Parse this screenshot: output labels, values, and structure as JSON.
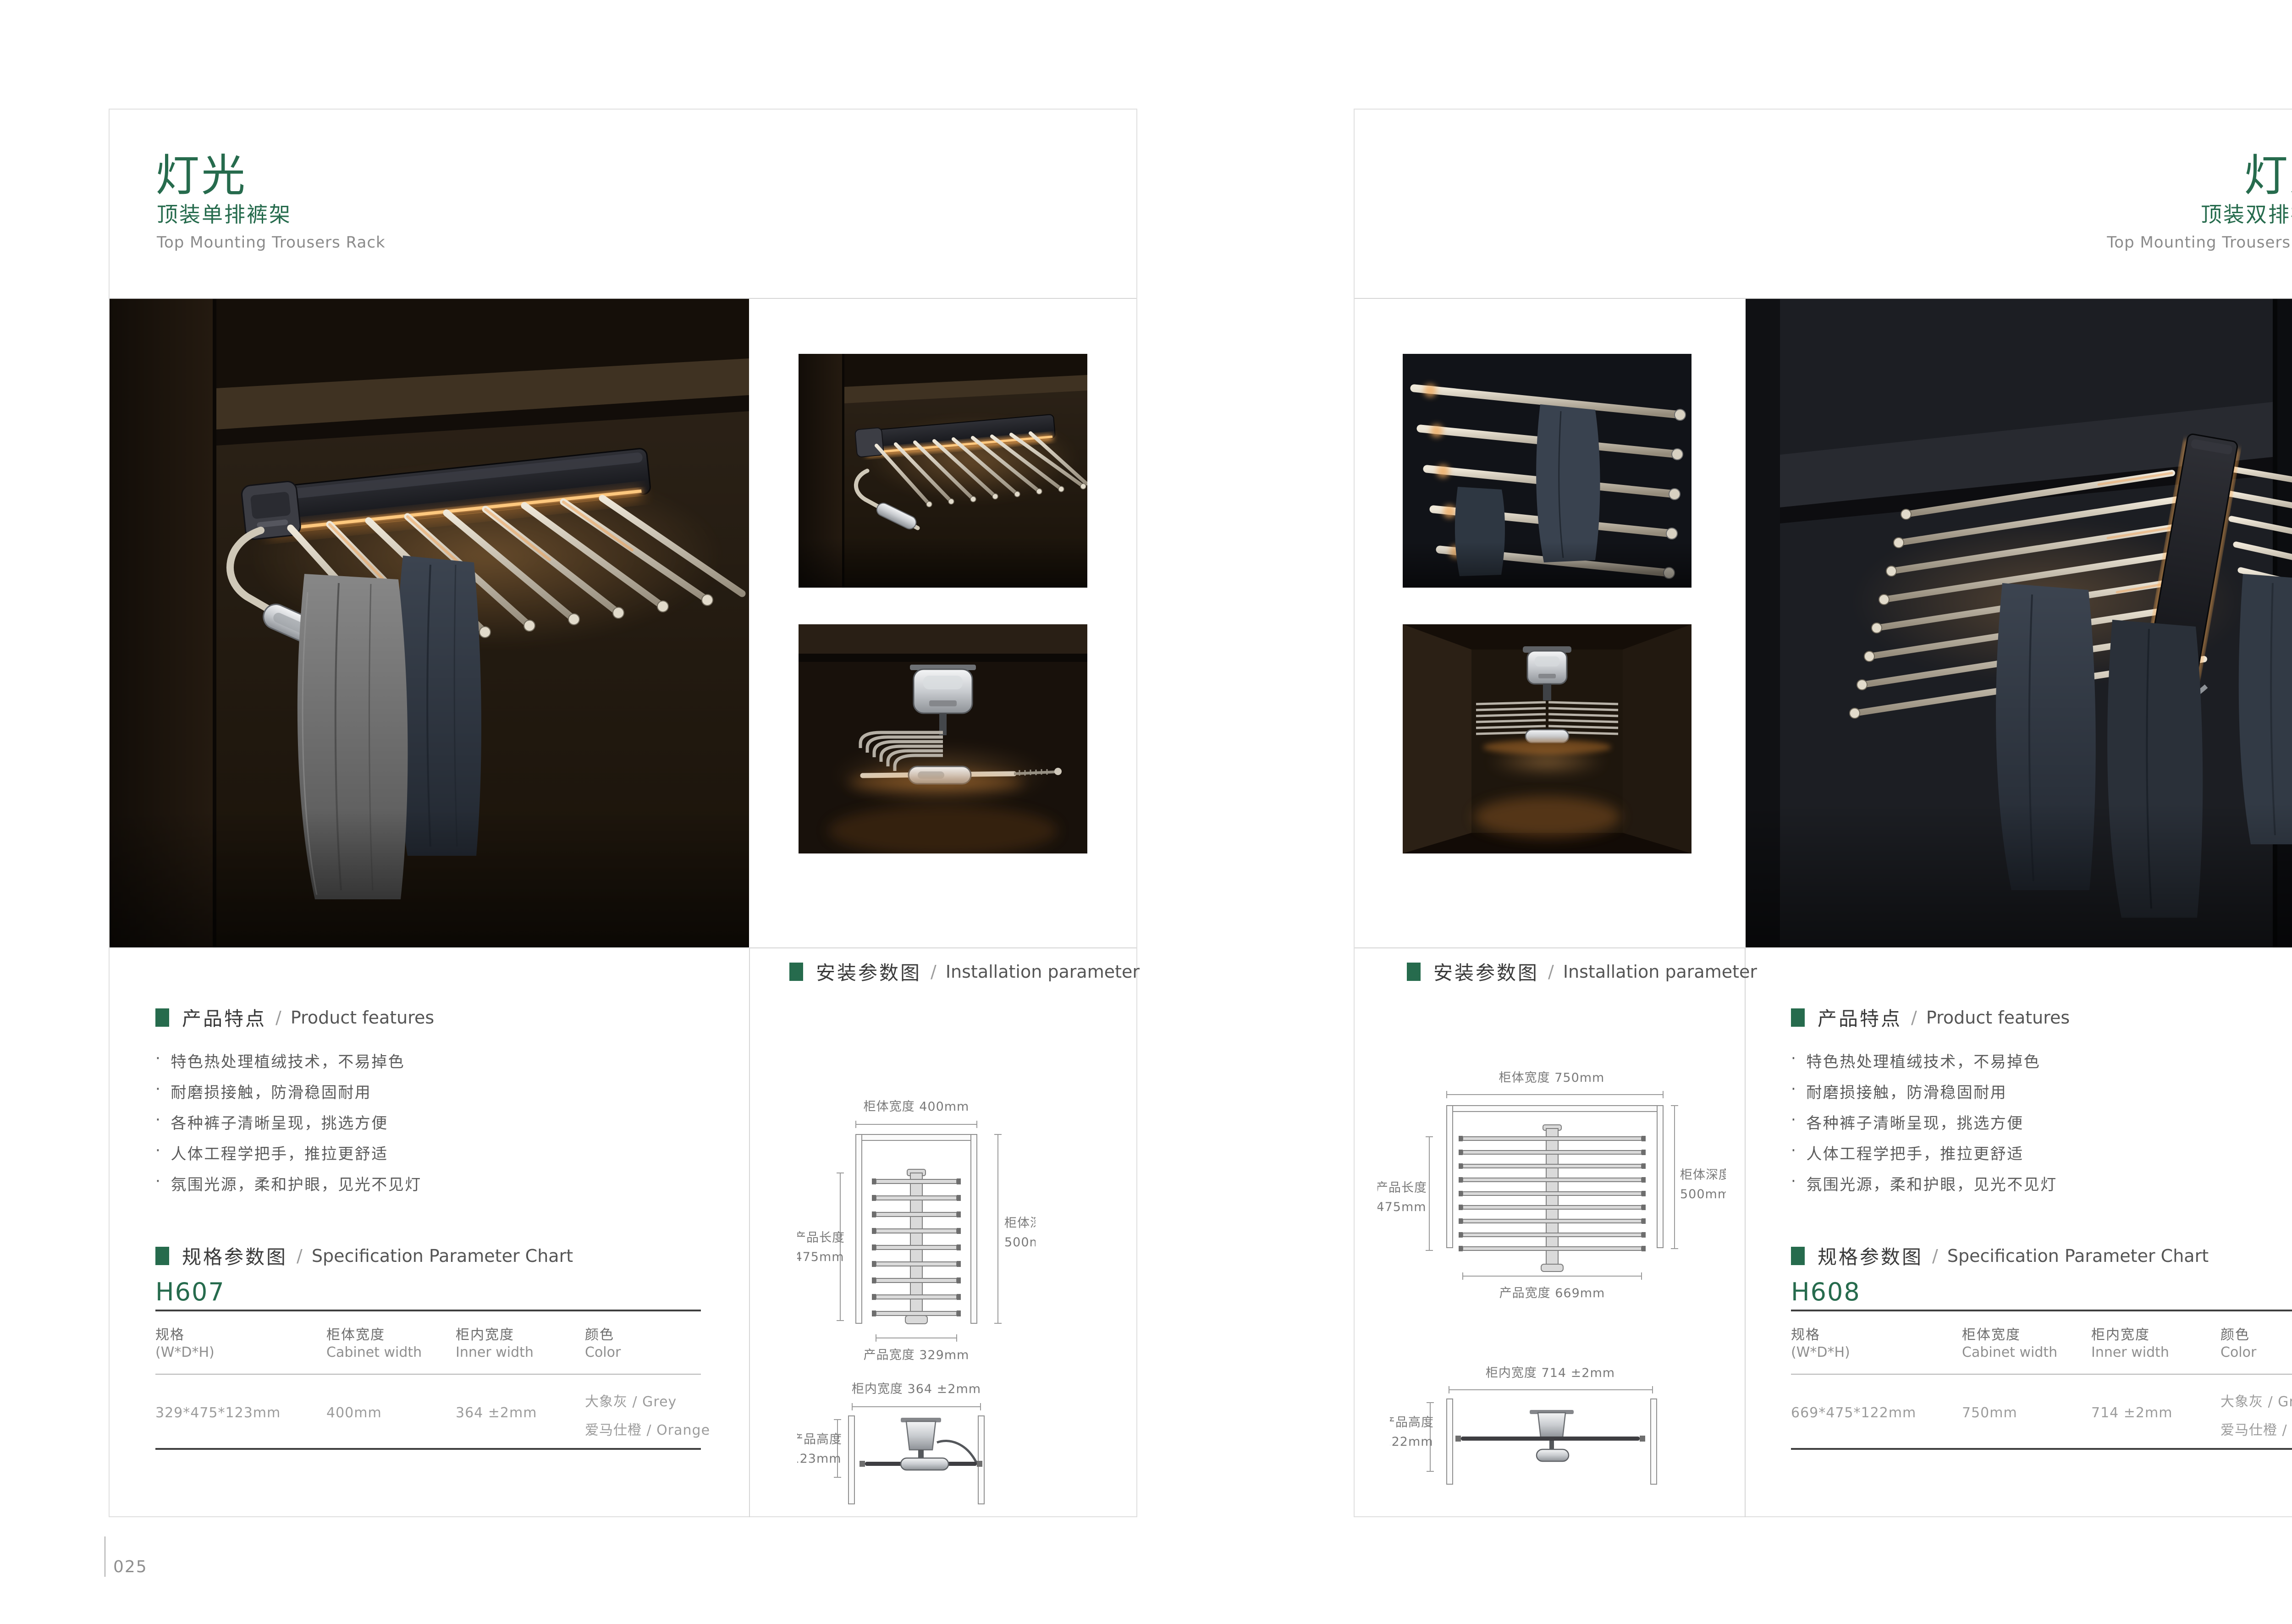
{
  "colors": {
    "accent_green": "#266B4D",
    "led_glow": "#FFAE54",
    "text_light": "#9C9C9C"
  },
  "shared": {
    "sep": "/",
    "features_label_zh": "产品特点",
    "features_label_en": "Product features",
    "spec_label_zh": "规格参数图",
    "spec_label_en": "Specification Parameter Chart",
    "install_label_zh": "安装参数图",
    "install_label_en": "Installation parameter",
    "bullet_dot": "·",
    "features": [
      "特色热处理植绒技术，不易掉色",
      "耐磨损接触，防滑稳固耐用",
      "各种裤子清晰呈现，挑选方便",
      "人体工程学把手，推拉更舒适",
      "氛围光源，柔和护眼，见光不见灯"
    ],
    "table_columns": [
      {
        "zh": "规格",
        "en": "(W*D*H)"
      },
      {
        "zh": "柜体宽度",
        "en": "Cabinet width"
      },
      {
        "zh": "柜内宽度",
        "en": "Inner width"
      },
      {
        "zh": "颜色",
        "en": "Color"
      }
    ]
  },
  "left_page": {
    "page_number": "025",
    "title": "灯光",
    "subtitle": "顶装单排裤架",
    "subtitle_en": "Top Mounting Trousers Rack",
    "model": "H607",
    "spec_row": {
      "size": "329*475*123mm",
      "cabinet_width": "400mm",
      "inner_width": "364 ±2mm",
      "color1": "大象灰 / Grey",
      "color2": "爱马仕橙 / Orange"
    },
    "install": {
      "top": {
        "cab_w": "柜体宽度 400mm",
        "prod_len_zh": "产品长度",
        "prod_len_val": "475mm",
        "cab_d_zh": "柜体深度",
        "cab_d_val": "500mm",
        "prod_w": "产品宽度 329mm"
      },
      "front": {
        "inner_w": "柜内宽度 364 ±2mm",
        "prod_h_zh": "产品高度",
        "prod_h_val": "123mm"
      }
    }
  },
  "right_page": {
    "page_number": "026",
    "title": "灯光",
    "subtitle": "顶装双排裤架",
    "subtitle_en": "Top Mounting Trousers Rack",
    "model": "H608",
    "spec_row": {
      "size": "669*475*122mm",
      "cabinet_width": "750mm",
      "inner_width": "714 ±2mm",
      "color1": "大象灰 / Grey",
      "color2": "爱马仕橙 / Orange"
    },
    "install": {
      "top": {
        "cab_w": "柜体宽度 750mm",
        "prod_len_zh": "产品长度",
        "prod_len_val": "475mm",
        "cab_d_zh": "柜体深度",
        "cab_d_val": "500mm",
        "prod_w": "产品宽度 669mm"
      },
      "front": {
        "inner_w": "柜内宽度 714 ±2mm",
        "prod_h_zh": "产品高度",
        "prod_h_val": "122mm"
      }
    }
  }
}
